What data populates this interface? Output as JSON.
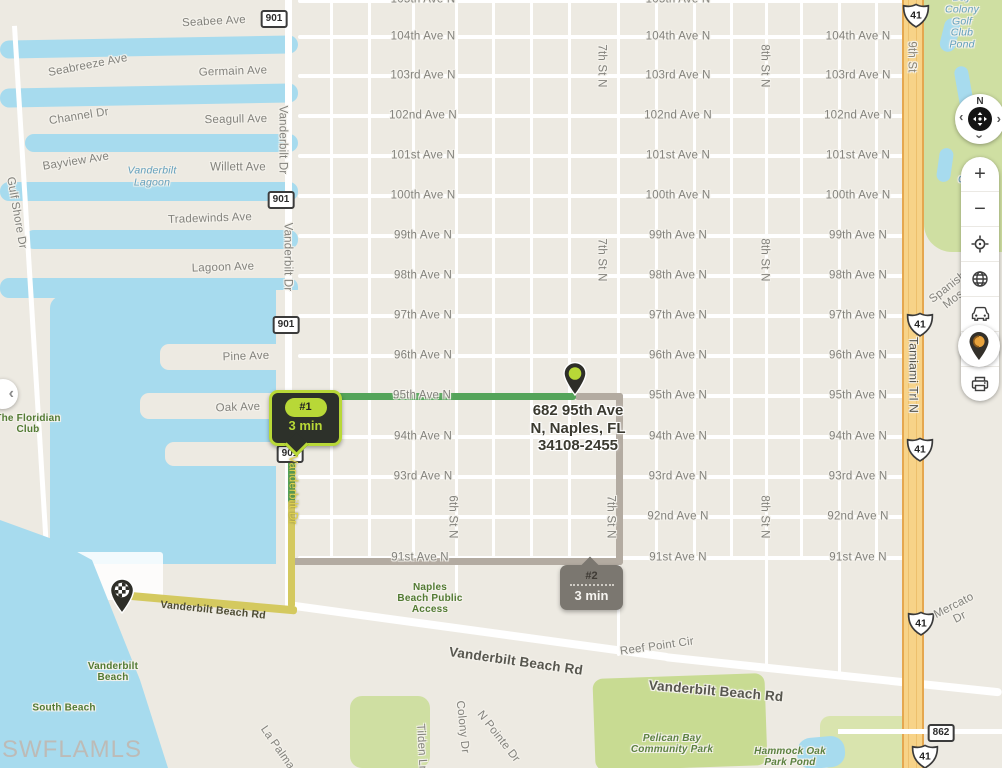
{
  "watermark": "SWFLAMLS",
  "address": {
    "line1": "682 95th Ave",
    "line2": "N, Naples, FL",
    "line3": "34108-2455"
  },
  "routes": [
    {
      "badge": "#1",
      "duration": "3 min",
      "color": "#54a45a"
    },
    {
      "badge": "#2",
      "duration": "3 min",
      "color": "#b3aba1"
    }
  ],
  "controls": {
    "compass": {
      "north": "N",
      "chevron": "›"
    },
    "zoom_in": "+",
    "zoom_out": "−",
    "collapse_glyph": "‹",
    "buttons": [
      "zoom-in",
      "zoom-out",
      "locate",
      "globe",
      "traffic",
      "export",
      "print",
      "marker"
    ]
  },
  "colors": {
    "water": "#a7dbee",
    "land": "#edeae2",
    "park": "#cfdfa2",
    "route_green": "#54a45a",
    "route_yellow": "#d4c95f",
    "route_gray": "#b3aba1",
    "badge_lime": "#b8d837",
    "highway": "#f7d388"
  },
  "shields": {
    "items": [
      {
        "type": "rect",
        "text": "901",
        "x": 274,
        "y": 19
      },
      {
        "type": "rect",
        "text": "901",
        "x": 281,
        "y": 200
      },
      {
        "type": "rect",
        "text": "901",
        "x": 286,
        "y": 325
      },
      {
        "type": "rect",
        "text": "901",
        "x": 290,
        "y": 454
      },
      {
        "type": "rect",
        "text": "862",
        "x": 941,
        "y": 733
      },
      {
        "type": "us",
        "text": "41",
        "x": 916,
        "y": 18
      },
      {
        "type": "us",
        "text": "41",
        "x": 920,
        "y": 327
      },
      {
        "type": "us",
        "text": "41",
        "x": 920,
        "y": 452
      },
      {
        "type": "us",
        "text": "41",
        "x": 921,
        "y": 626
      },
      {
        "type": "us",
        "text": "41",
        "x": 925,
        "y": 759
      }
    ]
  },
  "avenues": {
    "rows": [
      {
        "label": "105th Ave N",
        "y": 0,
        "cols": [
          423,
          678
        ]
      },
      {
        "label": "104th Ave N",
        "y": 37,
        "cols": [
          423,
          678,
          858
        ]
      },
      {
        "label": "103rd Ave N",
        "y": 76,
        "cols": [
          423,
          678,
          858
        ]
      },
      {
        "label": "102nd Ave N",
        "y": 116,
        "cols": [
          423,
          678,
          858
        ]
      },
      {
        "label": "101st Ave N",
        "y": 156,
        "cols": [
          423,
          678,
          858
        ]
      },
      {
        "label": "100th Ave N",
        "y": 196,
        "cols": [
          423,
          678,
          858
        ]
      },
      {
        "label": "99th Ave N",
        "y": 236,
        "cols": [
          423,
          678,
          858
        ]
      },
      {
        "label": "98th Ave N",
        "y": 276,
        "cols": [
          423,
          678,
          858
        ]
      },
      {
        "label": "97th Ave N",
        "y": 316,
        "cols": [
          423,
          678,
          858
        ]
      },
      {
        "label": "96th Ave N",
        "y": 356,
        "cols": [
          423,
          678,
          858
        ]
      },
      {
        "label": "95th Ave N",
        "y": 396,
        "cols": [
          422,
          678,
          858
        ]
      },
      {
        "label": "94th Ave N",
        "y": 437,
        "cols": [
          423,
          678,
          858
        ]
      },
      {
        "label": "93rd Ave N",
        "y": 477,
        "cols": [
          423,
          678,
          858
        ]
      },
      {
        "label": "92nd Ave N",
        "y": 517,
        "cols": [
          678,
          858
        ]
      },
      {
        "label": "91st Ave N",
        "y": 558,
        "cols": [
          420,
          678,
          858
        ]
      }
    ]
  },
  "map_labels": [
    {
      "text": "Seabee Ave",
      "x": 214,
      "y": 22,
      "rot": -3
    },
    {
      "text": "Germain Ave",
      "x": 233,
      "y": 72,
      "rot": -2
    },
    {
      "text": "Seagull Ave",
      "x": 236,
      "y": 120,
      "rot": -1
    },
    {
      "text": "Willett Ave",
      "x": 238,
      "y": 168,
      "rot": 0
    },
    {
      "text": "Tradewinds Ave",
      "x": 210,
      "y": 219,
      "rot": -2
    },
    {
      "text": "Lagoon Ave",
      "x": 223,
      "y": 268,
      "rot": -2
    },
    {
      "text": "Pine Ave",
      "x": 246,
      "y": 357,
      "rot": -2
    },
    {
      "text": "Oak Ave",
      "x": 238,
      "y": 408,
      "rot": -2
    },
    {
      "text": "Seabreeze Ave",
      "x": 88,
      "y": 66,
      "rot": -11
    },
    {
      "text": "Channel Dr",
      "x": 79,
      "y": 117,
      "rot": -9
    },
    {
      "text": "Bayview Ave",
      "x": 76,
      "y": 162,
      "rot": -9
    },
    {
      "text": "Gulf Shore Dr",
      "x": 16,
      "y": 213,
      "rot": 80
    },
    {
      "text": "Vanderbilt Dr",
      "x": 282,
      "y": 140,
      "rot": 90
    },
    {
      "text": "Vanderbilt Dr",
      "x": 287,
      "y": 257,
      "rot": 90
    },
    {
      "text": "Vanderbilt Dr",
      "x": 292,
      "y": 490,
      "rot": 90,
      "cls": "lbl-yellow"
    },
    {
      "text": "6th St N",
      "x": 452,
      "y": 517,
      "rot": 90
    },
    {
      "text": "7th St N",
      "x": 601,
      "y": 66,
      "rot": 90
    },
    {
      "text": "7th St N",
      "x": 601,
      "y": 260,
      "rot": 90
    },
    {
      "text": "7th St N",
      "x": 610,
      "y": 517,
      "rot": 90
    },
    {
      "text": "8th St N",
      "x": 764,
      "y": 66,
      "rot": 90
    },
    {
      "text": "8th St N",
      "x": 764,
      "y": 260,
      "rot": 90
    },
    {
      "text": "8th St N",
      "x": 764,
      "y": 517,
      "rot": 90
    },
    {
      "text": "9th St",
      "x": 911,
      "y": 57,
      "rot": 90,
      "cls": "lbl-onroad"
    },
    {
      "text": "Tamiami Trl N",
      "x": 913,
      "y": 375,
      "rot": 90,
      "cls": "lbl-dark"
    },
    {
      "text": "Mercato Dr",
      "x": 957,
      "y": 612,
      "rot": -27
    },
    {
      "text": "Reef Point Cir",
      "x": 657,
      "y": 647,
      "rot": -8
    },
    {
      "text": "Colony Dr",
      "x": 462,
      "y": 727,
      "rot": 84
    },
    {
      "text": "N Pointe Dr",
      "x": 498,
      "y": 737,
      "rot": 52
    },
    {
      "text": "Tilden Ln",
      "x": 421,
      "y": 748,
      "rot": 87
    },
    {
      "text": "La Palma",
      "x": 277,
      "y": 748,
      "rot": 55
    },
    {
      "text": "Spanish Moss",
      "x": 952,
      "y": 293,
      "rot": -38
    },
    {
      "text": "Vanderbilt Beach Rd",
      "x": 213,
      "y": 611,
      "rot": 6,
      "cls": "lbl-onyellow"
    },
    {
      "text": "Vanderbilt Beach Rd",
      "x": 516,
      "y": 661,
      "rot": 8,
      "cls": "lbl-road-big"
    },
    {
      "text": "Vanderbilt Beach Rd",
      "x": 716,
      "y": 691,
      "rot": 5,
      "cls": "lbl-road-big"
    },
    {
      "text": "The Floridian\nClub",
      "x": 28,
      "y": 424,
      "cls": "lbl-green"
    },
    {
      "text": "Vanderbilt\nBeach",
      "x": 113,
      "y": 672,
      "cls": "lbl-green"
    },
    {
      "text": "South Beach",
      "x": 64,
      "y": 708,
      "cls": "lbl-green"
    },
    {
      "text": "Naples\nBeach Public\nAccess",
      "x": 430,
      "y": 599,
      "cls": "lbl-green"
    },
    {
      "text": "Pelican Bay\nCommunity Park",
      "x": 672,
      "y": 744,
      "cls": "lbl-green-it"
    },
    {
      "text": "Hammock Oak\nPark Pond",
      "x": 790,
      "y": 757,
      "cls": "lbl-green-it"
    },
    {
      "text": "Vanderbilt\nLagoon",
      "x": 152,
      "y": 177,
      "cls": "lbl-water"
    },
    {
      "text": "Bay Colony\nGolf Club Pond",
      "x": 962,
      "y": 22,
      "cls": "lbl-water"
    },
    {
      "text": "Bay Colony\nGolf Club Pond",
      "x": 975,
      "y": 192,
      "cls": "lbl-water"
    }
  ]
}
